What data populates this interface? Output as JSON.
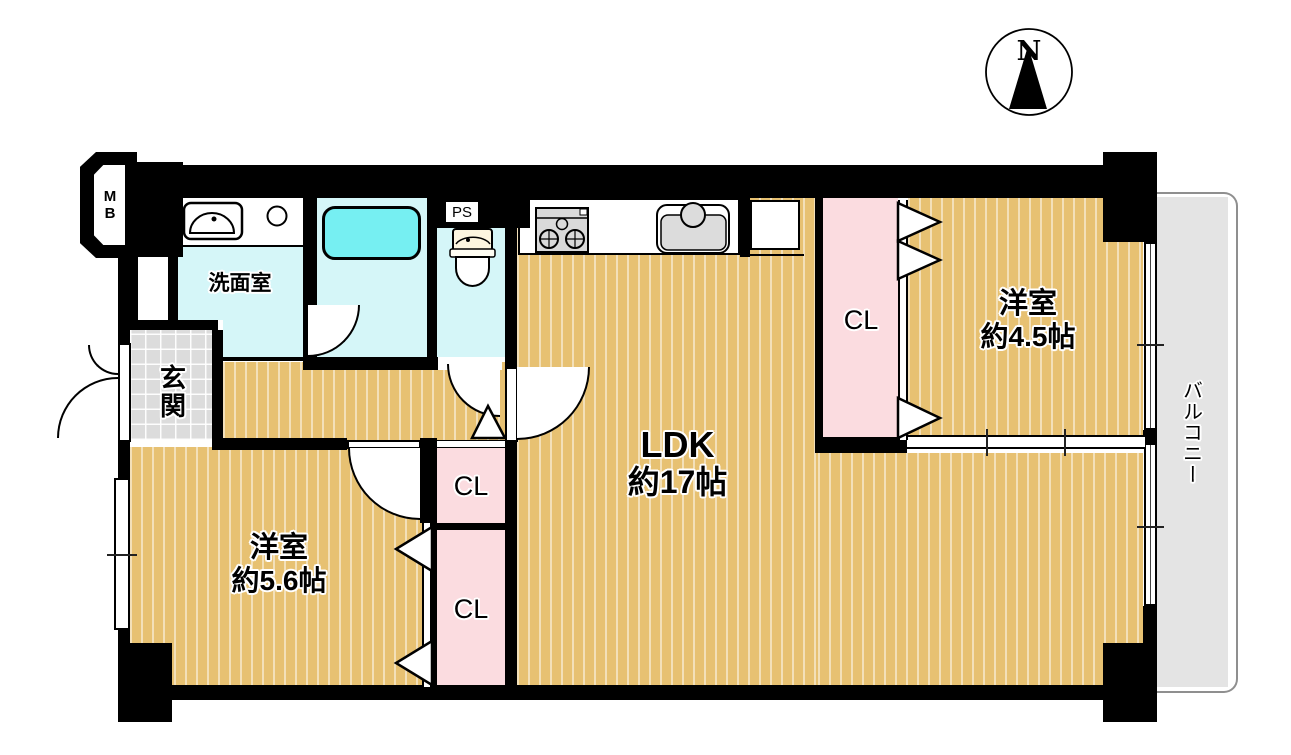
{
  "compass": {
    "north_label": "N"
  },
  "rooms": {
    "ldk": {
      "name": "LDK",
      "size": "約17帖"
    },
    "west56": {
      "name": "洋室",
      "size": "約5.6帖"
    },
    "west45": {
      "name": "洋室",
      "size": "約4.5帖"
    },
    "washroom": {
      "name": "洗面室"
    },
    "genkan": {
      "name": "玄関"
    },
    "balcony": {
      "name": "バルコニー"
    }
  },
  "closet_label": "CL",
  "utility": {
    "meter_box": "MB",
    "pipe_space": "PS"
  },
  "colors": {
    "wall": "#000000",
    "wood_floor": "#e7c172",
    "closet_pink": "#fbdce0",
    "wet_area_cyan": "#d5f6f8",
    "bathtub_cyan": "#76eff2",
    "balcony_gray": "#e4e4e4",
    "entry_tile_gray": "#dcdcdc",
    "balcony_border_gray": "#8f8f8f"
  }
}
